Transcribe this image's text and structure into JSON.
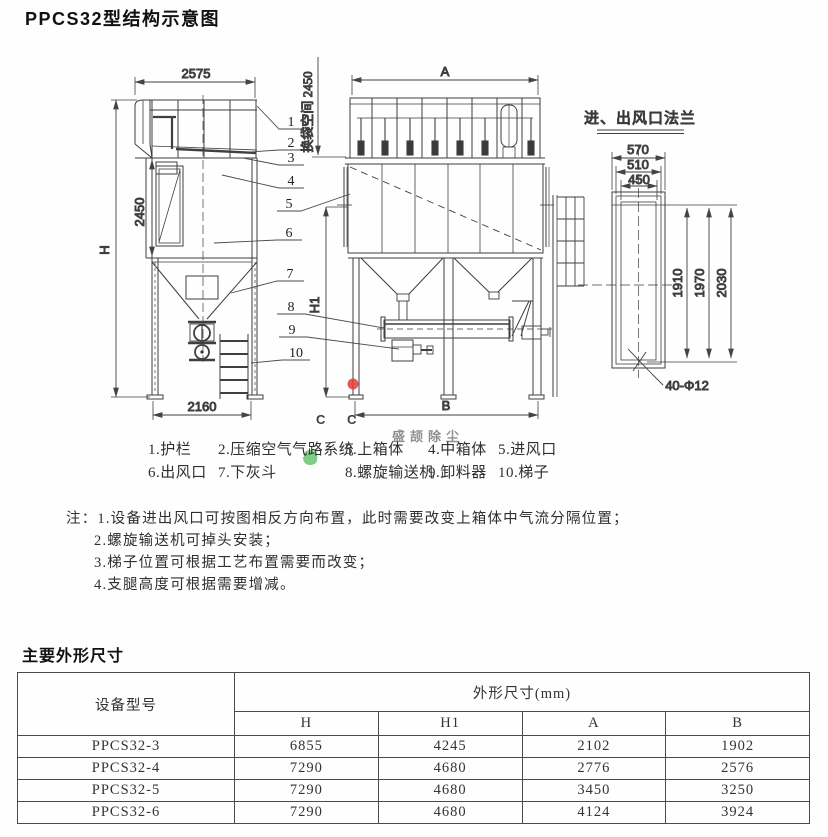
{
  "page": {
    "title": "PPCS32型结构示意图",
    "section2_title": "主要外形尺寸"
  },
  "drawing": {
    "side_view": {
      "top_width": "2575",
      "overall_height": "H",
      "box_height": "2450",
      "base_width": "2160"
    },
    "front_view": {
      "top_width": "A",
      "mid_height": "H1",
      "base_width": "B",
      "bag_space": "换袋空间 2450"
    },
    "flange_view": {
      "title": "进、出风口法兰",
      "w_outer": "570",
      "w_mid": "510",
      "w_inner": "450",
      "h_inner": "1910",
      "h_mid": "1970",
      "h_outer": "2030",
      "bolt_spec": "40-Φ12"
    },
    "part_numbers": [
      "1",
      "2",
      "3",
      "4",
      "5",
      "6",
      "7",
      "8",
      "9",
      "10"
    ],
    "line_color": "#3f3f3f",
    "watermark": {
      "logo_letter": "S",
      "logo_sub_letter_1": "C",
      "logo_sub_letter_2": "C",
      "brand_text": "盛颉除尘",
      "green": "#62c168",
      "blue": "#4d97dd",
      "yellow": "#f2d024",
      "red": "#e23b3b"
    }
  },
  "legend": {
    "row1": [
      "1.护栏",
      "2.压缩空气气路系统",
      "3.上箱体",
      "4.中箱体",
      "5.进风口"
    ],
    "row2": [
      "6.出风口",
      "7.下灰斗",
      "8.螺旋输送机",
      "9.卸料器",
      "10.梯子"
    ]
  },
  "notes": {
    "prefix": "注：",
    "items": [
      "1.设备进出风口可按图相反方向布置，此时需要改变上箱体中气流分隔位置；",
      "2.螺旋输送机可掉头安装；",
      "3.梯子位置可根据工艺布置需要而改变；",
      "4.支腿高度可根据需要增减。"
    ]
  },
  "table": {
    "col1_header": "设备型号",
    "group_header": "外形尺寸(mm)",
    "sub_headers": [
      "H",
      "H1",
      "A",
      "B"
    ],
    "rows": [
      {
        "model": "PPCS32-3",
        "values": [
          "6855",
          "4245",
          "2102",
          "1902"
        ]
      },
      {
        "model": "PPCS32-4",
        "values": [
          "7290",
          "4680",
          "2776",
          "2576"
        ]
      },
      {
        "model": "PPCS32-5",
        "values": [
          "7290",
          "4680",
          "3450",
          "3250"
        ]
      },
      {
        "model": "PPCS32-6",
        "values": [
          "7290",
          "4680",
          "4124",
          "3924"
        ]
      }
    ]
  }
}
